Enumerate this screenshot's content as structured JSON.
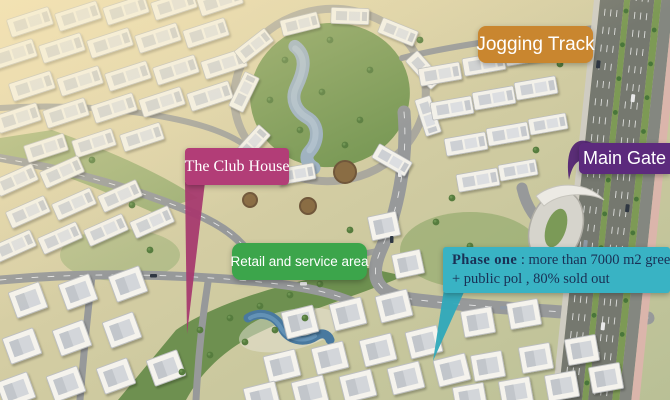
{
  "labels": {
    "jogging_track": {
      "text": "Jogging Track",
      "color": "#c9862f"
    },
    "club_house": {
      "text": "The Club House",
      "color": "#b23d77",
      "pointer_color": "#a63a6f"
    },
    "retail": {
      "text": "Retail and service area",
      "color": "#3ca54b"
    },
    "main_gate": {
      "text": "Main Gate",
      "color": "#5c2a7d",
      "pointer_color": "#532574"
    },
    "phase_one": {
      "title": "Phase one",
      "line1": " : more than 7000 m2 green a",
      "line2": "+ public pol , 80% sold out",
      "color": "#39b3c4",
      "text_color": "#1a3055",
      "pointer_color": "#2fa9bb"
    }
  },
  "scene": {
    "type": "aerial-masterplan-render",
    "features": [
      "apartment-blocks",
      "villas",
      "central-lake-park",
      "ring-road",
      "main-boulevard",
      "internal-avenue",
      "gate-plaza",
      "club-house-pool",
      "linear-greenway",
      "round-plazas",
      "palm-trees"
    ]
  }
}
